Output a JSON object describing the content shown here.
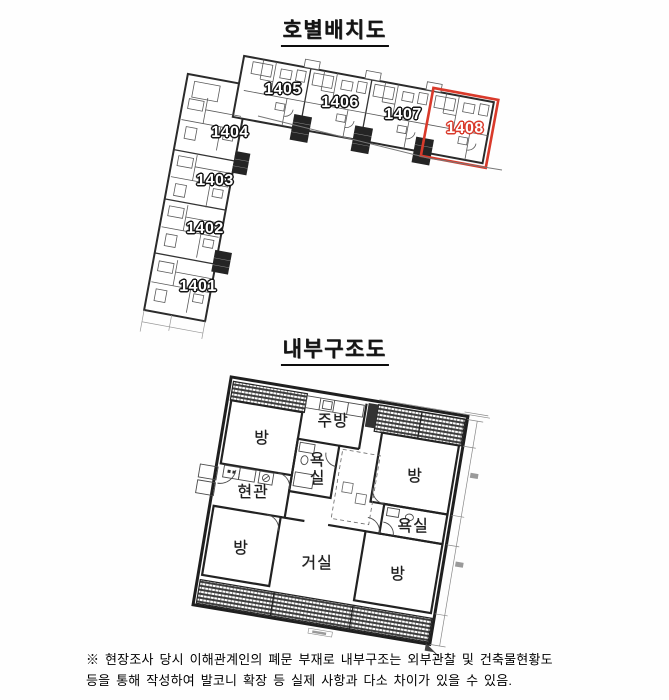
{
  "unit_layout": {
    "title": "호별배치도",
    "highlight_color": "#d93a2b",
    "highlighted_unit": "1408",
    "units": [
      {
        "label": "1401"
      },
      {
        "label": "1402"
      },
      {
        "label": "1403"
      },
      {
        "label": "1404"
      },
      {
        "label": "1405"
      },
      {
        "label": "1406"
      },
      {
        "label": "1407"
      },
      {
        "label": "1408"
      }
    ]
  },
  "internal_structure": {
    "title": "내부구조도",
    "rooms": [
      {
        "label": "방"
      },
      {
        "label": "주방"
      },
      {
        "label": "욕실"
      },
      {
        "label": "현관"
      },
      {
        "label": "방"
      },
      {
        "label": "거실"
      },
      {
        "label": "방"
      },
      {
        "label": "욕실"
      },
      {
        "label": "방"
      }
    ]
  },
  "footnote": {
    "line1": "※ 현장조사 당시 이해관계인의 폐문 부재로 내부구조는 외부관찰 및 건축물현황도",
    "line2": "등을 통해 작성하여 발코니 확장 등 실제 사항과 다소 차이가 있을 수 있음."
  }
}
